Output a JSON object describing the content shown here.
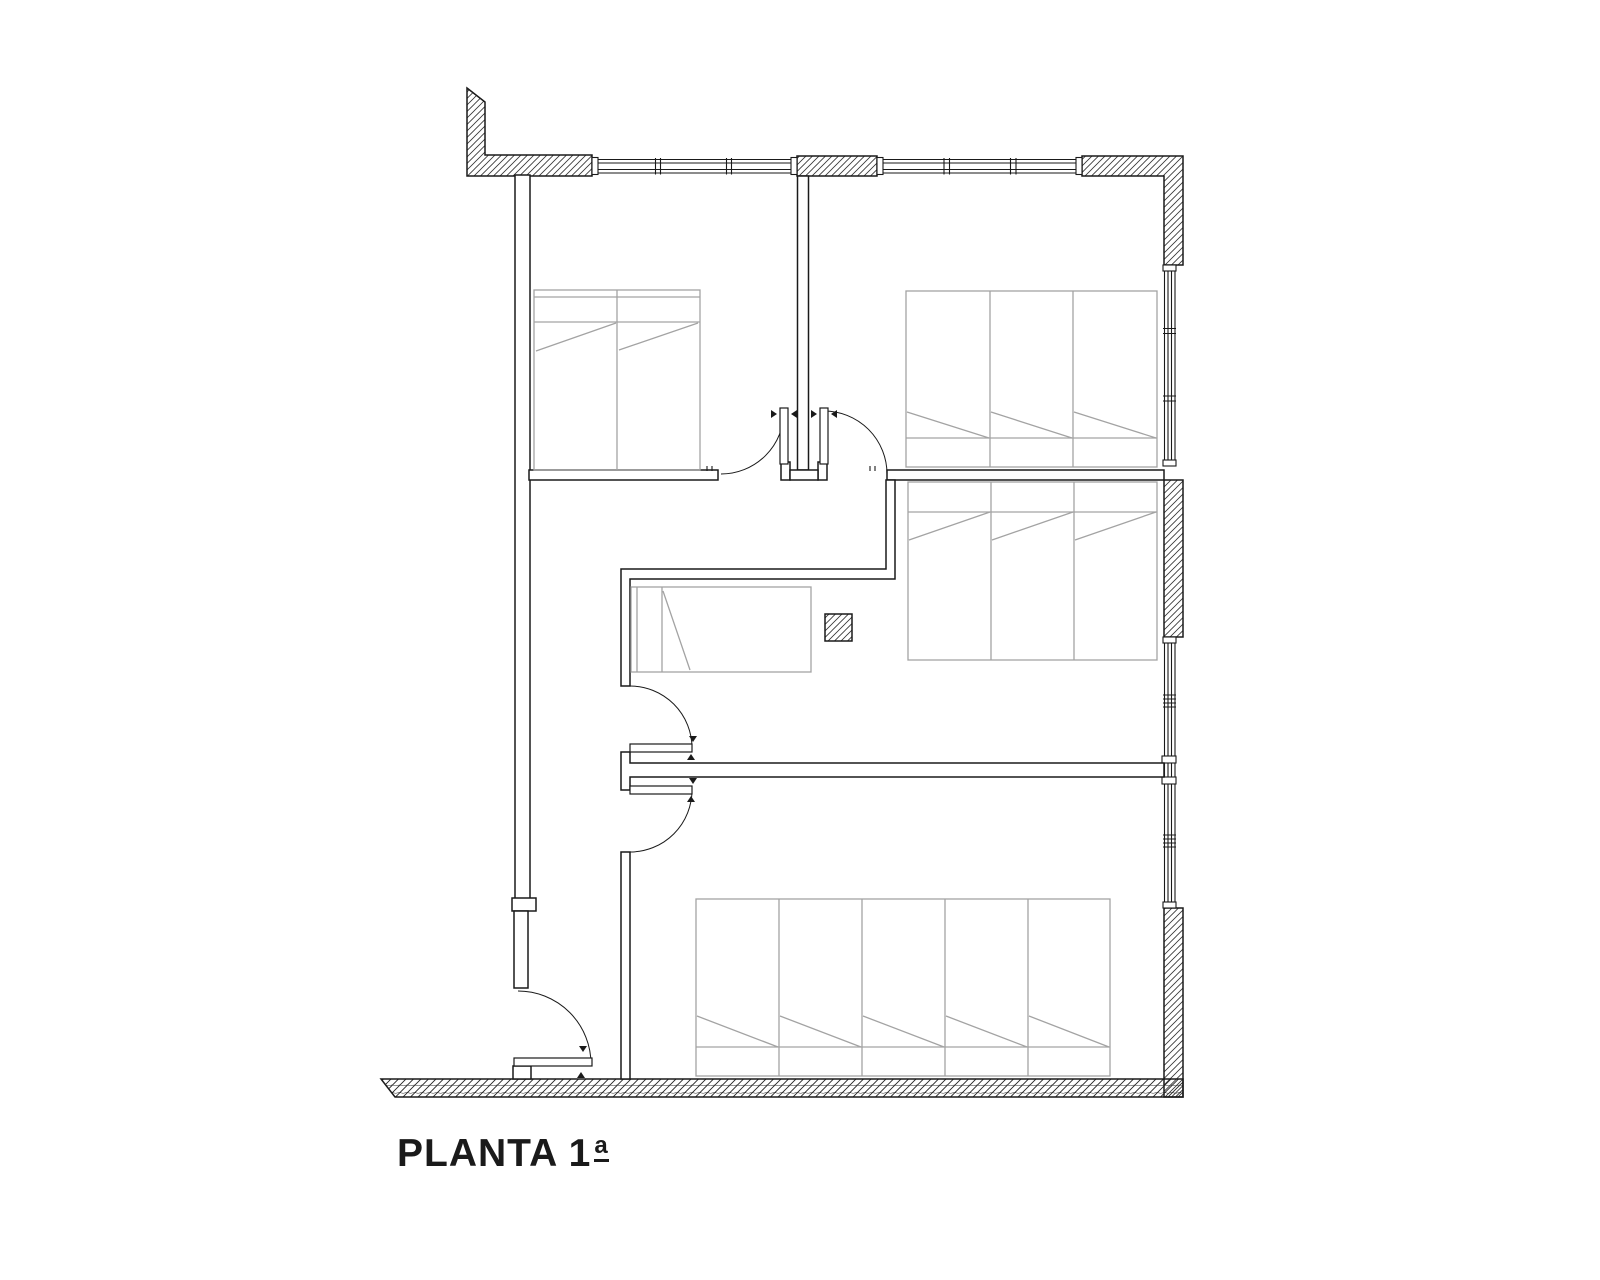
{
  "title": {
    "text": "PLANTA 1ª",
    "main": "PLANTA 1",
    "ordinal": "a"
  },
  "colors": {
    "ink": "#1a1a1a",
    "furniture": "#a3a3a3",
    "background": "#ffffff"
  }
}
